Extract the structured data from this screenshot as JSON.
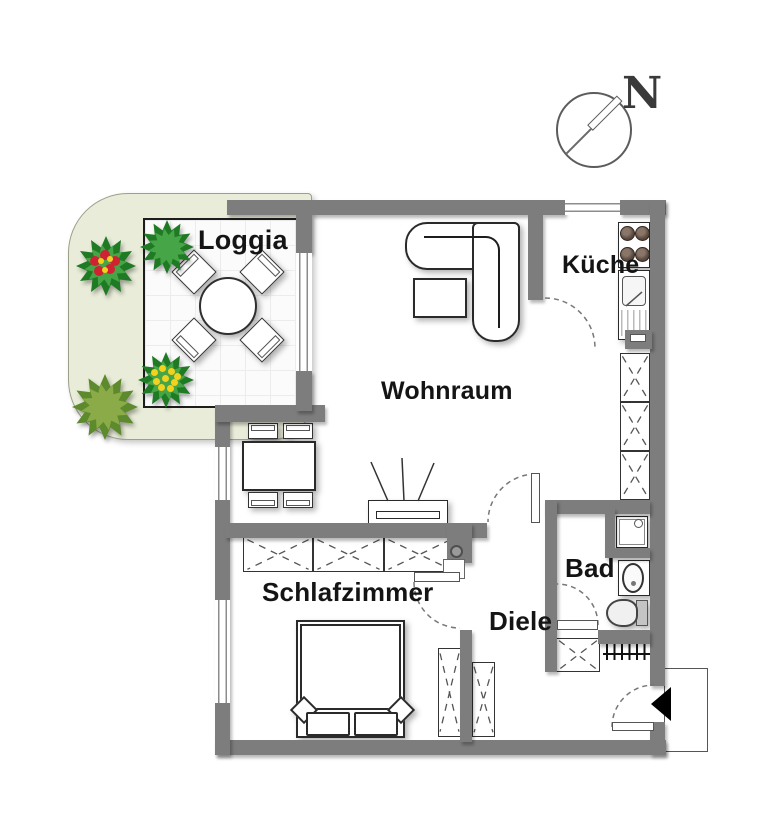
{
  "title": "Apartment floor plan",
  "compass": {
    "label": "N"
  },
  "rooms": {
    "loggia": {
      "label": "Loggia"
    },
    "wohnraum": {
      "label": "Wohnraum"
    },
    "kueche": {
      "label": "Küche"
    },
    "schlafzimmer": {
      "label": "Schlafzimmer"
    },
    "bad": {
      "label": "Bad"
    },
    "diele": {
      "label": "Diele"
    }
  },
  "features": [
    "north-compass",
    "garden",
    "terrace-tiles",
    "round-table-with-chairs",
    "flowering-bushes",
    "corner-sofa",
    "coffee-table",
    "dining-table-with-chairs",
    "tv-sideboard",
    "stove",
    "kitchen-sink",
    "built-in-wardrobes",
    "double-bed",
    "shower",
    "washbasin",
    "toilet",
    "radiator",
    "entrance-door-arrow",
    "door-swings",
    "windows"
  ],
  "colors": {
    "wall": "#7d7d7d",
    "garden": "#e8ecd8",
    "bushDark": "#1f7a24",
    "bushLight": "#46a546",
    "flowerRed": "#cf2233",
    "flowerYellow": "#f2d21f",
    "line": "#1d1d1d"
  }
}
